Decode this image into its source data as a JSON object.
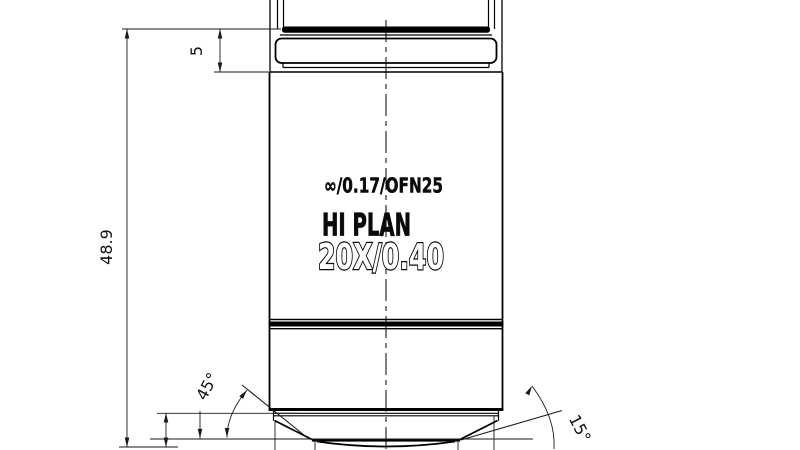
{
  "engraving": {
    "line1": "∞/0.17/OFN25",
    "line2": "HI PLAN",
    "line3": "20X/0.40"
  },
  "dimensions": {
    "overall_height": "48.9",
    "thread_length": "5",
    "chamfer_angle": "45°",
    "front_angle": "15°"
  },
  "colors": {
    "line": "#000000",
    "background": "#ffffff"
  }
}
